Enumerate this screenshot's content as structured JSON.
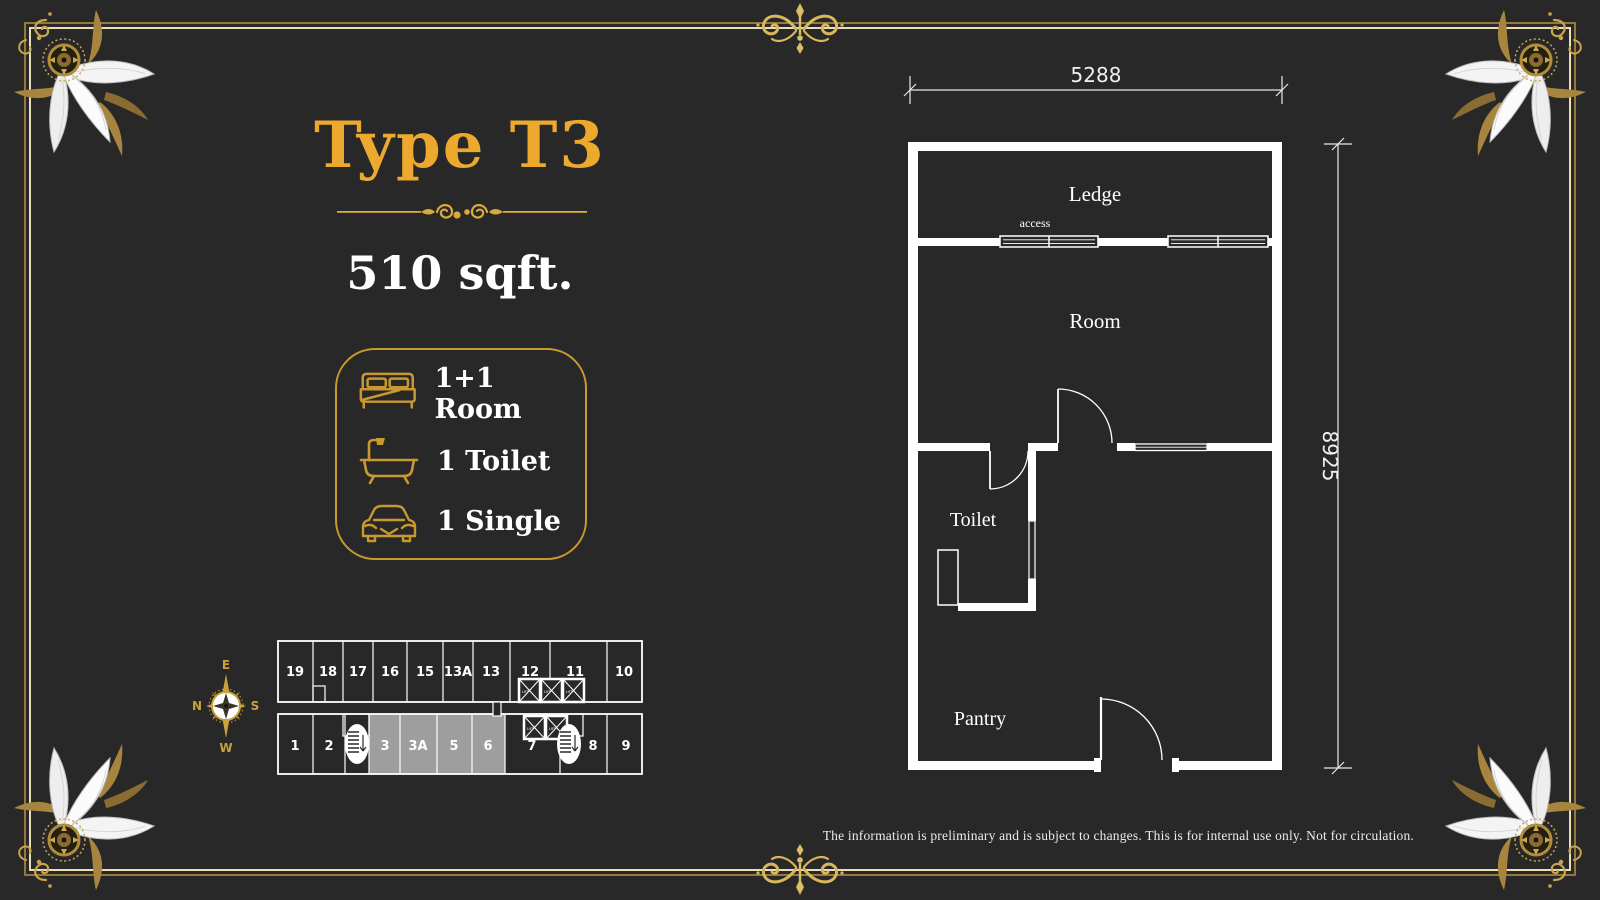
{
  "colors": {
    "background": "#282828",
    "gold_title": "#eda92e",
    "gold_outline": "#c9992f",
    "frame_gold": "#97783c",
    "frame_cream": "#e9ddba",
    "plan_line": "#ffffff",
    "highlight_gray": "#9e9e9e"
  },
  "header": {
    "title": "Type T3",
    "area": "510 sqft."
  },
  "amenities": {
    "items": [
      {
        "icon": "bed-icon",
        "label": "1+1 Room"
      },
      {
        "icon": "bathtub-icon",
        "label": "1 Toilet"
      },
      {
        "icon": "car-icon",
        "label": "1 Single"
      }
    ]
  },
  "compass": {
    "east": "E",
    "north": "N",
    "south": "S",
    "west": "W"
  },
  "keyplan": {
    "top_units": [
      "19",
      "18",
      "17",
      "16",
      "15",
      "13A",
      "13",
      "12",
      "11",
      "10"
    ],
    "bottom_units": [
      "1",
      "2",
      "3",
      "3A",
      "5",
      "6",
      "7",
      "8",
      "9"
    ],
    "highlighted_units": [
      "3",
      "3A",
      "5",
      "6"
    ],
    "lift_label": "LIFT"
  },
  "floorplan": {
    "rooms": {
      "ledge": "Ledge",
      "access": "access",
      "room": "Room",
      "toilet": "Toilet",
      "pantry": "Pantry"
    },
    "dimensions": {
      "width": "5288",
      "height": "8925"
    }
  },
  "footer": {
    "disclaimer": "The information is preliminary and is subject to changes. This is for internal use only. Not for circulation."
  }
}
